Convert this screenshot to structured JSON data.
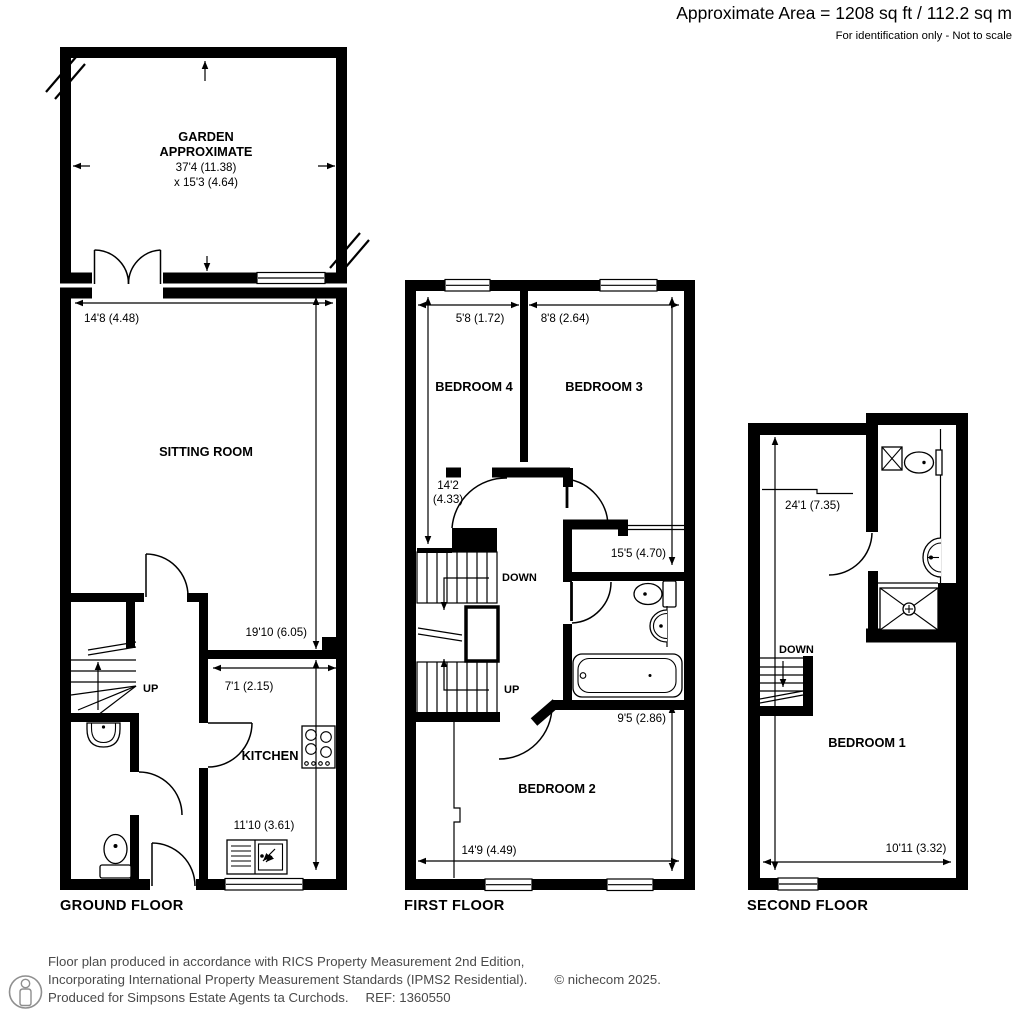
{
  "header": {
    "area": "Approximate Area = 1208 sq ft / 112.2 sq m",
    "disclaimer": "For identification only - Not to scale"
  },
  "ground_floor": {
    "label": "GROUND FLOOR",
    "garden": {
      "name_line1": "GARDEN",
      "name_line2": "APPROXIMATE",
      "dim_width": "37'4 (11.38)",
      "dim_depth": "x 15'3 (4.64)"
    },
    "sitting_room": {
      "name": "SITTING ROOM",
      "dim_width": "14'8 (4.48)",
      "dim_depth": "19'10 (6.05)"
    },
    "kitchen": {
      "name": "KITCHEN",
      "dim_width": "7'1 (2.15)",
      "dim_depth": "11'10 (3.61)"
    },
    "stairs": {
      "up": "UP"
    }
  },
  "first_floor": {
    "label": "FIRST FLOOR",
    "bedroom4": {
      "name": "BEDROOM 4",
      "dim_width": "5'8 (1.72)",
      "dim_depth_line1": "14'2",
      "dim_depth_line2": "(4.33)"
    },
    "bedroom3": {
      "name": "BEDROOM 3",
      "dim_width": "8'8 (2.64)",
      "dim_depth": "15'5 (4.70)"
    },
    "bedroom2": {
      "name": "BEDROOM 2",
      "dim_width": "14'9 (4.49)",
      "dim_depth": "9'5 (2.86)"
    },
    "stairs": {
      "down": "DOWN",
      "up": "UP"
    }
  },
  "second_floor": {
    "label": "SECOND FLOOR",
    "bedroom1": {
      "name": "BEDROOM 1",
      "dim_width": "10'11 (3.32)",
      "dim_depth": "24'1 (7.35)"
    },
    "stairs": {
      "down": "DOWN"
    }
  },
  "footer": {
    "line1": "Floor plan produced in accordance with RICS Property Measurement 2nd Edition,",
    "line2": "Incorporating International Property Measurement Standards (IPMS2 Residential).",
    "copyright": "© nichecom 2025.",
    "line3": "Produced for Simpsons Estate Agents ta Curchods.",
    "ref": "REF: 1360550"
  },
  "colors": {
    "wall": "#000000",
    "text": "#000000",
    "footer_text": "#4a4a4a",
    "icon_gray": "#8f8f8f"
  }
}
